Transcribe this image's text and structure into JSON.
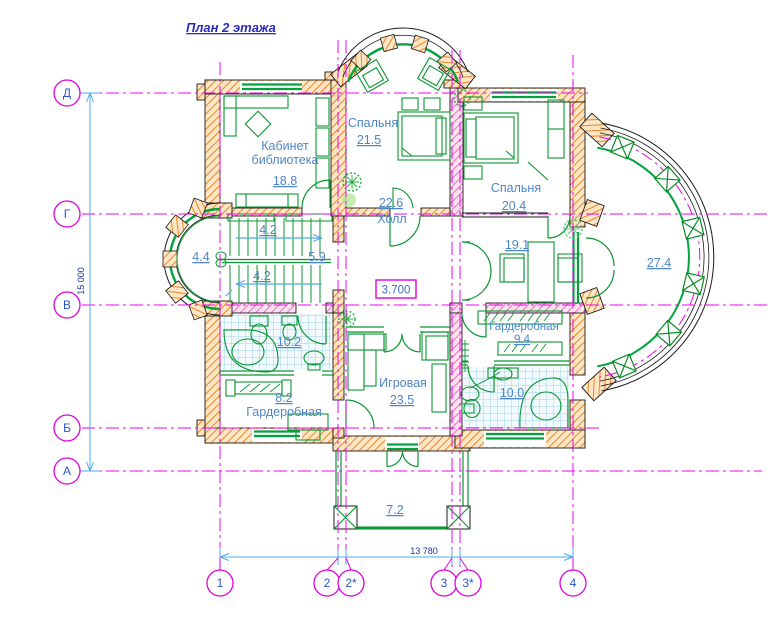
{
  "title": "План 2 этажа",
  "elevation_mark": "3.700",
  "axes": {
    "left": [
      "Д",
      "Г",
      "В",
      "Б",
      "А"
    ],
    "bottom": [
      "1",
      "2",
      "2*",
      "3",
      "3*",
      "4"
    ]
  },
  "dimensions": {
    "vertical": "15 000",
    "horizontal": "13 780"
  },
  "rooms": {
    "cabinet": {
      "name": "Кабинет",
      "name2": "библиотека",
      "area": "18.8"
    },
    "bedroom1": {
      "name": "Спальня",
      "area": "21.5"
    },
    "bedroom2": {
      "name": "Спальня",
      "area": "20.4"
    },
    "hall": {
      "name": "Холл",
      "area": "22.6"
    },
    "study": {
      "area": "19.1"
    },
    "terrace": {
      "area": "27.4"
    },
    "bath1": {
      "area": "10.2"
    },
    "wardrobe1": {
      "name": "Гардеробная",
      "area": "8.2"
    },
    "playroom": {
      "name": "Игровая",
      "area": "23.5"
    },
    "wardrobe2": {
      "name": "Гардеробная",
      "area": "9.4"
    },
    "bath2": {
      "area": "10.0"
    },
    "balcony": {
      "area": "7.2"
    },
    "stair_bay": {
      "area": "4.4"
    },
    "stair_hall": {
      "area": "5.9"
    },
    "stair_run_top": {
      "area": "4.2"
    },
    "stair_run_bottom": {
      "area": "4.2"
    }
  },
  "colors": {
    "axis": "#f000f0",
    "dimension": "#4fabe8",
    "room_label": "#4e86c8",
    "wall_hatch": "#e8872f",
    "window_green": "#00a33c",
    "title_blue": "#2b2bbf"
  }
}
